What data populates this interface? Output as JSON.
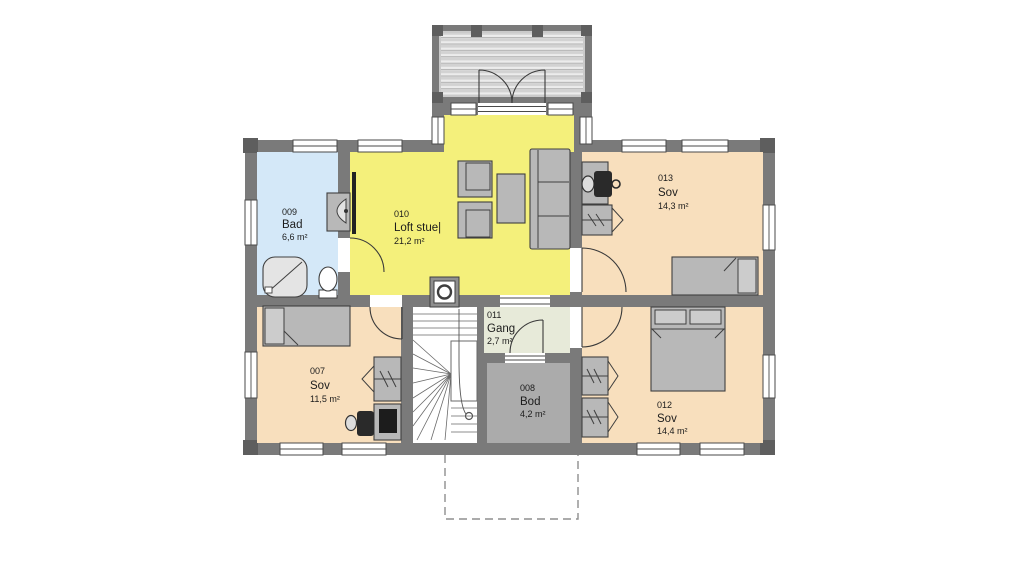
{
  "rooms": {
    "bad": {
      "id": "009",
      "name": "Bad",
      "area": "6,6 m²",
      "color": "#d4e8f8"
    },
    "loft": {
      "id": "010",
      "name": "Loft stue|",
      "area": "21,2 m²",
      "color": "#f4f07b"
    },
    "sov013": {
      "id": "013",
      "name": "Sov",
      "area": "14,3 m²",
      "color": "#f8dfbd"
    },
    "sov007": {
      "id": "007",
      "name": "Sov",
      "area": "11,5 m²",
      "color": "#f8dfbd"
    },
    "gang": {
      "id": "011",
      "name": "Gang",
      "area": "2,7 m²",
      "color": "#e7ead9"
    },
    "bod": {
      "id": "008",
      "name": "Bod",
      "area": "4,2 m²",
      "color": "#ababab"
    },
    "sov012": {
      "id": "012",
      "name": "Sov",
      "area": "14,4 m²",
      "color": "#f8dfbd"
    }
  },
  "palette": {
    "wall": "#7a7a7a",
    "wall_post": "#5e5e5e",
    "furniture": "#b8b8b8",
    "outline": "#3f3f3f",
    "porch_dash": "#8f8f8f"
  }
}
